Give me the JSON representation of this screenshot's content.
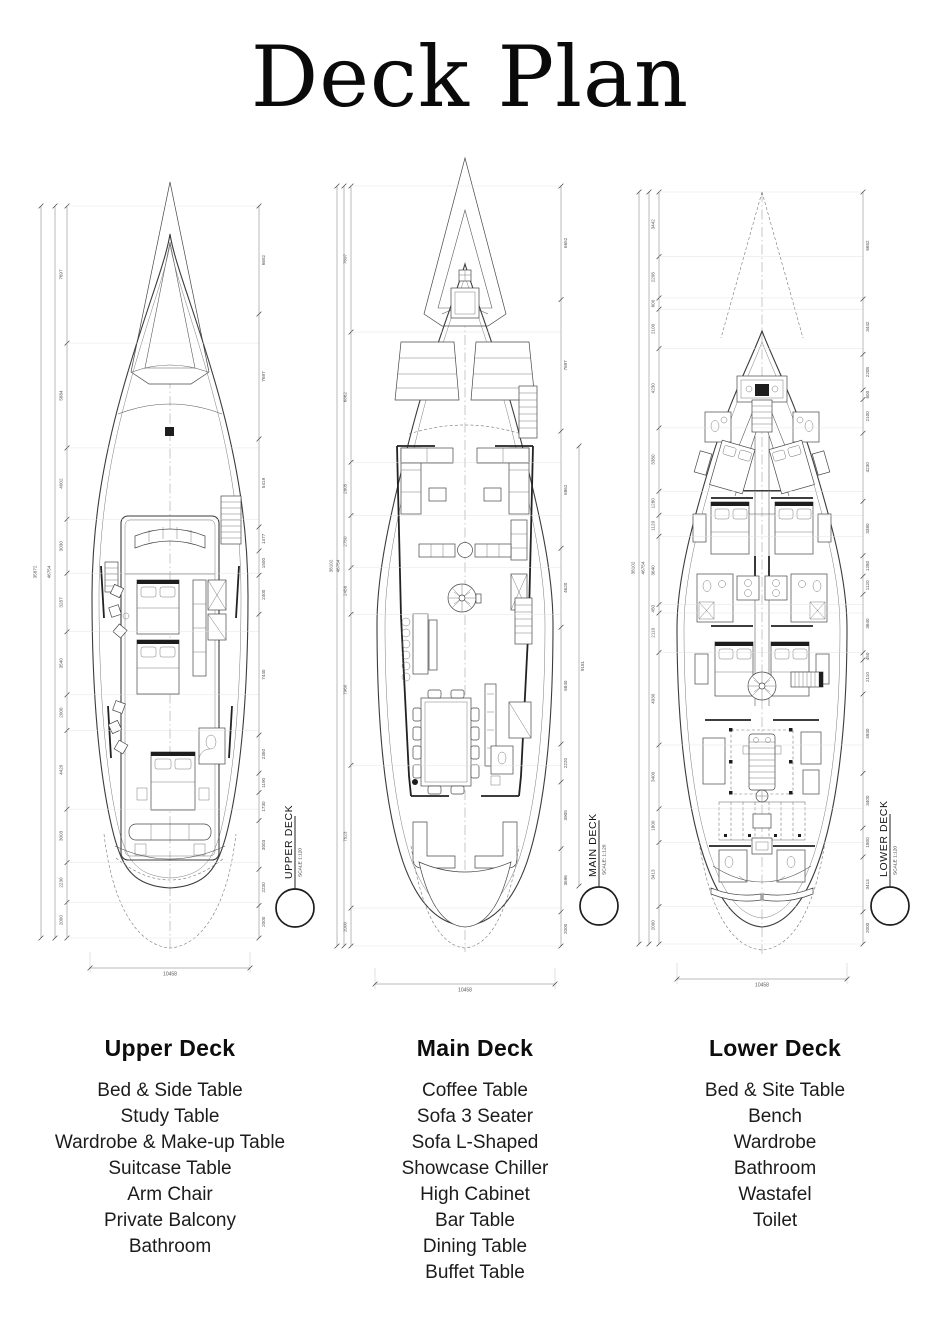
{
  "title": "Deck Plan",
  "decks": [
    {
      "name": "UPPER DECK",
      "scale": "SCALE 1:120",
      "heading": "Upper Deck",
      "items": [
        "Bed & Side Table",
        "Study Table",
        "Wardrobe & Make-up Table",
        "Suitcase Table",
        "Arm Chair",
        "Private Balcony",
        "Bathroom"
      ],
      "left_totals": [
        "35872",
        "46754"
      ],
      "right_totals": [],
      "left_dims": [
        "7697",
        "5884",
        "4002",
        "3030",
        "3287",
        "3540",
        "2000",
        "4420",
        "3003",
        "2230",
        "2000"
      ],
      "right_dims": [
        "6652",
        "7697",
        "5419",
        "1477",
        "1500",
        "2400",
        "7440",
        "2350",
        "1190",
        "1730",
        "3003",
        "2230",
        "2000"
      ],
      "bottom_width": "10458"
    },
    {
      "name": "MAIN DECK",
      "scale": "SCALE: 1:120",
      "heading": "Main Deck",
      "items": [
        "Coffee Table",
        "Sofa 3 Seater",
        "Sofa L-Shaped",
        "Showcase Chiller",
        "High Cabinet",
        "Bar Table",
        "Dining Table",
        "Buffet Table"
      ],
      "left_totals": [
        "38102",
        "46754"
      ],
      "right_totals": [
        "9181"
      ],
      "left_dims": [
        "7697",
        "6862",
        "2805",
        "2750",
        "2456",
        "7960",
        "7523",
        "2000"
      ],
      "right_dims": [
        "6652",
        "7697",
        "6862",
        "4620",
        "6840",
        "2220",
        "3905",
        "3696",
        "2000"
      ],
      "bottom_width": "10458"
    },
    {
      "name": "LOWER DECK",
      "scale": "SCALE 1:120",
      "heading": "Lower Deck",
      "items": [
        "Bed & Site Table",
        "Bench",
        "Wardrobe",
        "Bathroom",
        "Wastafel",
        "Toilet"
      ],
      "left_totals": [
        "38102",
        "46754"
      ],
      "right_totals": [],
      "left_dims": [
        "3442",
        "2208",
        "600",
        "2100",
        "4230",
        "3380",
        "1280",
        "1120",
        "3640",
        "450",
        "2110",
        "4930",
        "3400",
        "1800",
        "3413",
        "2000"
      ],
      "right_dims": [
        "6652",
        "3442",
        "2208",
        "600",
        "2100",
        "4230",
        "3380",
        "1280",
        "1120",
        "3640",
        "450",
        "2110",
        "4930",
        "3400",
        "1800",
        "3413",
        "2000"
      ],
      "bottom_width": "10458"
    }
  ]
}
